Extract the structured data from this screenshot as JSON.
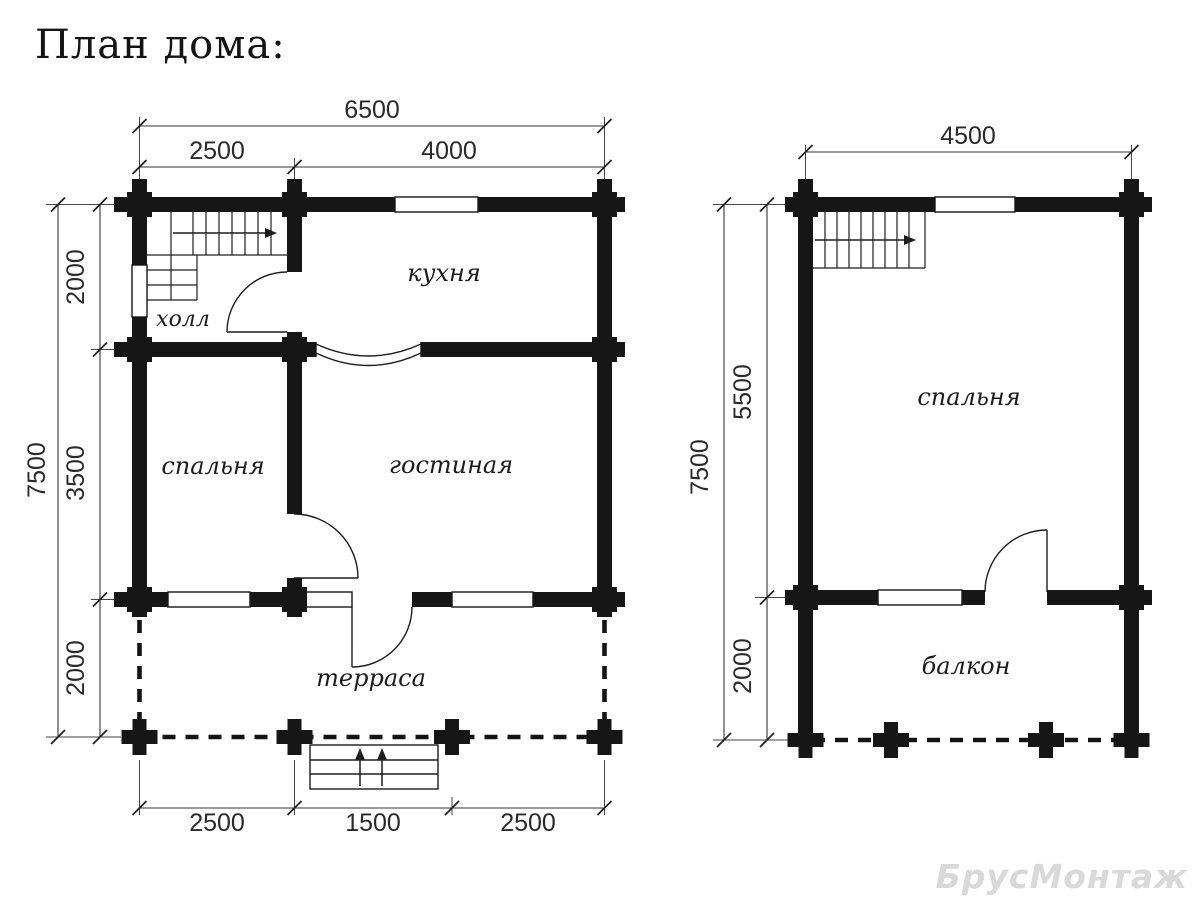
{
  "title": "План дома:",
  "watermark": "БрусМонтаж",
  "floor1": {
    "rooms": {
      "hall": "холл",
      "kitchen": "кухня",
      "bedroom": "спальня",
      "living_room": "гостиная",
      "terrace": "терраса"
    },
    "dimensions": {
      "width_total": "6500",
      "width_left": "2500",
      "width_right": "4000",
      "height_total": "7500",
      "height_top": "2000",
      "height_middle": "3500",
      "height_bottom": "2000",
      "bottom_left": "2500",
      "bottom_center": "1500",
      "bottom_right": "2500"
    }
  },
  "floor2": {
    "rooms": {
      "bedroom": "спальня",
      "balcony": "балкон"
    },
    "dimensions": {
      "width_total": "4500",
      "height_total": "7500",
      "height_top": "5500",
      "height_bottom": "2000"
    }
  },
  "colors": {
    "wall": "#161616",
    "line": "#333333",
    "dimension_text": "#2a2a2a",
    "watermark": "#d9d9d9",
    "background": "#ffffff"
  }
}
